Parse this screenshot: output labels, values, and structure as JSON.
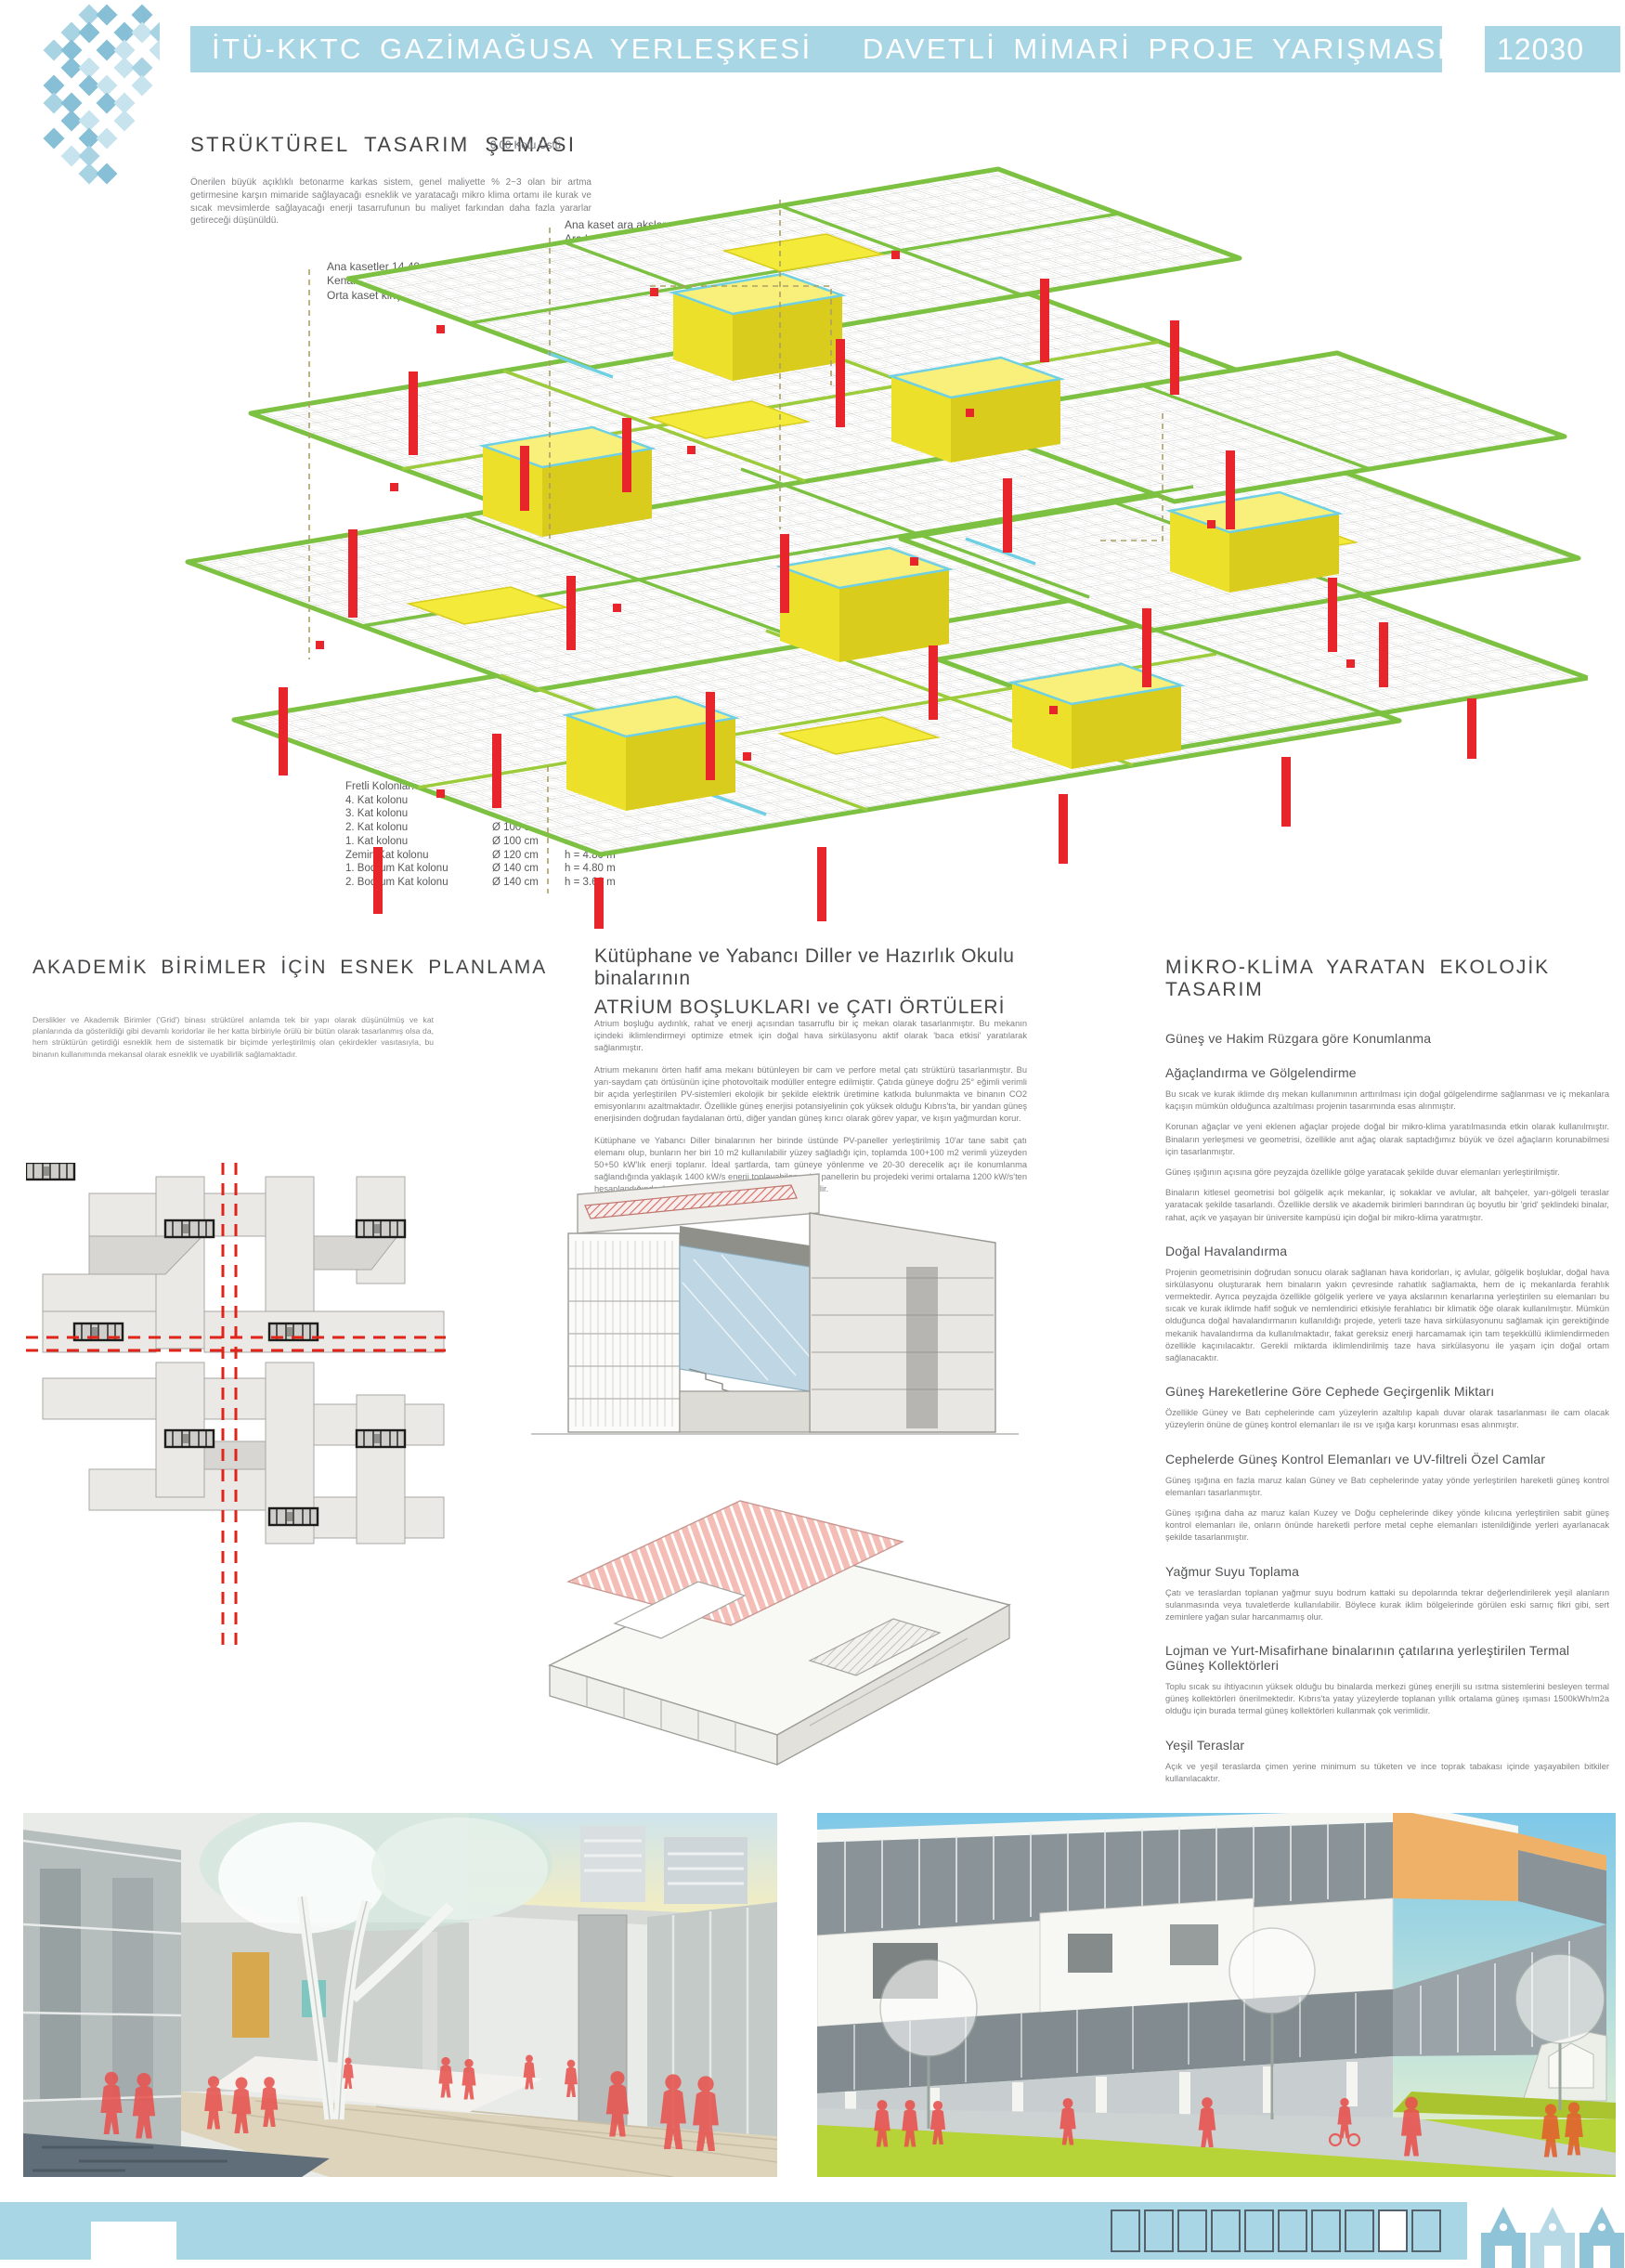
{
  "colors": {
    "header_blue": "#a9d6e5",
    "beam_green": "#7dc142",
    "slab_yellow": "#f3ea39",
    "column_red": "#e8252a",
    "core_cyan": "#6fd0e4",
    "axis_red": "#e0241a",
    "people_red": "#e85450",
    "lawn_green": "#b6d437",
    "accent_orange": "#efb168"
  },
  "header": {
    "title": "İTÜ-KKTC GAZİMAĞUSA YERLEŞKESİ   DAVETLİ MİMARİ PROJE YARIŞMASI",
    "code": "12030",
    "logo": "diamond-weave-logo"
  },
  "structural": {
    "heading": "STRÜKTÜREL  TASARIM  ŞEMASI",
    "subnote": "0.00 Kotu Üstü",
    "intro": "Önerilen büyük açıklıklı betonarme karkas sistem, genel maliyette % 2~3 olan bir artma getirmesine karşın mimaride sağlayacağı esneklik ve yaratacağı mikro klima ortamı ile kurak ve sıcak mevsimlerde sağlayacağı enerji tasarrufunun bu maliyet farkından daha fazla yararlar getireceği düşünüldü.",
    "annotations": {
      "ana_kaset": {
        "line1_label": "Ana kaset ara akslar",
        "line1_value": "4 x 3.60 m",
        "line2_label": "Ara kaset kiriş:",
        "line2_value": "40 / 80 cm"
      },
      "doseme": {
        "label": "Döşeme Plağı:",
        "value1": "3.60 x 3.60 m aks aralığı",
        "value2": "d = 12 cm"
      },
      "kasetler": {
        "line1": "Ana kasetler  14.40 m x 14.40 m  açıklıklı",
        "line2_label": "Kenar kaset kiriş:",
        "line2_value": "60 / 80 cm",
        "line3_label": "Orta kaset kiriş:",
        "line3_value": "80 / 80 cm"
      },
      "cekirdek": {
        "label": "Merdiven-Asansör Çekirdeği:",
        "value1": "14.40 x 4.80 m aks aralığı",
        "value2": "30 cm perde kalınlığı"
      },
      "kolonlar": {
        "title": "Fretli Kolonlar:",
        "rows": [
          {
            "name": "4. Kat kolonu",
            "dia": "Ø 80 cm",
            "h": "h = 3.60 m"
          },
          {
            "name": "3. Kat kolonu",
            "dia": "Ø 80 cm",
            "h": "h = 3.60 m"
          },
          {
            "name": "2. Kat kolonu",
            "dia": "Ø 100 cm",
            "h": "h = 3.60 m"
          },
          {
            "name": "1. Kat kolonu",
            "dia": "Ø 100 cm",
            "h": "h = 3.60 m"
          },
          {
            "name": "Zemin Kat kolonu",
            "dia": "Ø 120 cm",
            "h": "h = 4.80 m"
          },
          {
            "name": "1. Bodrum Kat kolonu",
            "dia": "Ø 140 cm",
            "h": "h = 4.80 m"
          },
          {
            "name": "2. Bodrum Kat kolonu",
            "dia": "Ø 140 cm",
            "h": "h = 3.60 m"
          }
        ]
      }
    }
  },
  "col1": {
    "heading": "AKADEMİK  BİRİMLER  İÇİN  ESNEK  PLANLAMA",
    "body": "Derslikler ve Akademik Birimler ('Grid') binası strüktürel anlamda tek bir yapı olarak düşünülmüş ve kat planlarında da gösterildiği gibi devamlı koridorlar ile her katta birbiriyle örülü bir bütün olarak tasarlanmış olsa da, hem strüktürün getirdiği esneklik hem de sistematik bir biçimde yerleştirilmiş olan çekirdekler vasıtasıyla, bu binanın kullanımında mekansal olarak esneklik ve uyabilirlik sağlamaktadır."
  },
  "col2": {
    "heading_line1": "Kütüphane ve Yabancı Diller ve Hazırlık Okulu binalarının",
    "heading_line2": "ATRİUM BOŞLUKLARI ve ÇATI ÖRTÜLERİ",
    "para1": "Atrium boşluğu aydınlık, rahat ve enerji açısından tasarruflu bir iç mekan olarak tasarlanmıştır. Bu mekanın içindeki iklimlendirmeyi optimize etmek için doğal hava sirkülasyonu aktif olarak 'baca etkisi' yaratılarak sağlanmıştır.",
    "para2": "Atrium mekanını örten hafif ama mekanı bütünleyen bir cam ve perfore metal çatı strüktürü tasarlanmıştır. Bu yarı-saydam çatı örtüsünün içine photovoltaik modüller entegre edilmiştir. Çatıda güneye doğru 25° eğimli verimli bir açıda yerleştirilen PV-sistemleri ekolojik bir şekilde elektrik üretimine katkıda bulunmakta ve binanın CO2 emisyonlarını azaltmaktadır. Özellikle güneş enerjisi potansiyelinin çok yüksek olduğu Kıbrıs'ta, bir yandan güneş enerjisinden doğrudan faydalanan örtü, diğer yandan güneş kırıcı olarak görev yapar, ve kışın yağmurdan korur.",
    "para3": "Kütüphane ve Yabancı Diller binalarının her birinde üstünde PV-paneller yerleştirilmiş 10'ar tane sabit çatı elemanı olup, bunların her biri 10 m2 kullanılabilir yüzey sağladığı için, toplamda 100+100 m2 verimli yüzeyden 50+50 kW'lık enerji toplanır. İdeal şartlarda, tam güneye yönlenme ve 20-30 derecelik açı ile konumlanma sağlandığında yaklaşık 1400 kW/s enerji toplayabilen solar panellerin bu projedeki verimi ortalama 1200 kW/s'ten hesaplandığında, her binada 60.000 kW/s üretim sağlanabilir."
  },
  "col3": {
    "heading": "MİKRO-KLİMA  YARATAN  EKOLOJİK  TASARIM",
    "sections": [
      {
        "h": "Güneş ve Hakim Rüzgara göre Konumlanma",
        "paras": []
      },
      {
        "h": "Ağaçlandırma ve Gölgelendirme",
        "paras": [
          "Bu sıcak ve kurak iklimde dış mekan kullanımının arttırılması için doğal gölgelendirme sağlanması ve iç mekanlara kaçışın mümkün olduğunca azaltılması projenin tasarımında esas alınmıştır.",
          "Korunan ağaçlar ve yeni eklenen ağaçlar projede doğal bir mikro-klima yaratılmasında etkin olarak kullanılmıştır. Binaların yerleşmesi ve geometrisi, özellikle anıt ağaç olarak saptadığımız büyük ve özel ağaçların korunabilmesi için tasarlanmıştır.",
          "Güneş ışığının açısına göre peyzajda özellikle gölge yaratacak şekilde duvar elemanları yerleştirilmiştir.",
          "Binaların kitlesel geometrisi bol gölgelik açık mekanlar, iç sokaklar ve avlular, alt bahçeler, yarı-gölgeli teraslar yaratacak şekilde tasarlandı. Özellikle derslik ve akademik birimleri barındıran üç boyutlu bir 'grid' şeklindeki binalar, rahat, açık ve yaşayan bir üniversite kampüsü için doğal bir mikro-klima yaratmıştır."
        ]
      },
      {
        "h": "Doğal Havalandırma",
        "paras": [
          "Projenin geometrisinin doğrudan sonucu olarak sağlanan hava koridorları, iç avlular, gölgelik boşluklar, doğal hava sirkülasyonu oluşturarak hem binaların yakın çevresinde rahatlık sağlamakta, hem de iç mekanlarda ferahlık vermektedir. Ayrıca peyzajda özellikle gölgelik yerlere ve yaya akslarının kenarlarına yerleştirilen su elemanları bu sıcak ve kurak iklimde hafif soğuk ve nemlendirici etkisiyle ferahlatıcı bir klimatik öğe olarak kullanılmıştır. Mümkün olduğunca doğal havalandırmanın kullanıldığı projede, yeterli taze hava sirkülasyonunu sağlamak için gerektiğinde mekanik havalandırma da kullanılmaktadır, fakat gereksiz enerji harcamamak için tam teşekküllü iklimlendirmeden özellikle kaçınılacaktır. Gerekli miktarda iklimlendirilmiş taze hava sirkülasyonu ile yaşam için doğal ortam sağlanacaktır."
        ]
      },
      {
        "h": "Güneş Hareketlerine Göre Cephede Geçirgenlik Miktarı",
        "paras": [
          "Özellikle Güney ve Batı cephelerinde cam yüzeylerin azaltılıp kapalı duvar olarak tasarlanması ile cam olacak yüzeylerin önüne de güneş kontrol elemanları ile ısı ve ışığa karşı korunması esas alınmıştır."
        ]
      },
      {
        "h": "Cephelerde Güneş Kontrol Elemanları ve UV-filtreli Özel Camlar",
        "paras": [
          "Güneş ışığına en fazla maruz kalan Güney ve Batı cephelerinde yatay yönde yerleştirilen hareketli güneş kontrol elemanları tasarlanmıştır.",
          "Güneş ışığına daha az maruz kalan Kuzey ve Doğu cephelerinde dikey yönde kılıcına yerleştirilen sabit güneş kontrol elemanları ile, onların önünde hareketli perfore metal cephe elemanları istenildiğinde yerleri ayarlanacak şekilde tasarlanmıştır."
        ]
      },
      {
        "h": "Yağmur Suyu Toplama",
        "paras": [
          "Çatı ve teraslardan toplanan yağmur suyu bodrum kattaki su depolarında tekrar değerlendirilerek yeşil alanların sulanmasında veya tuvaletlerde kullanılabilir. Böylece kurak iklim bölgelerinde görülen eski sarnıç fikri gibi, sert zeminlere yağan sular harcanmamış olur."
        ]
      },
      {
        "h": "Lojman ve Yurt-Misafirhane binalarının çatılarına yerleştirilen Termal Güneş Kollektörleri",
        "paras": [
          "Toplu sıcak su ihtiyacının yüksek olduğu bu binalarda merkezi güneş enerjili su ısıtma sistemlerini besleyen termal güneş kollektörleri önerilmektedir. Kıbrıs'ta yatay yüzeylerde toplanan yıllık ortalama güneş ışıması 1500kWh/m2a olduğu için burada termal güneş kollektörleri kullanmak çok verimlidir."
        ]
      },
      {
        "h": "Yeşil Teraslar",
        "paras": [
          "Açık ve yeşil teraslarda çimen yerine minimum su tüketen ve ince toprak tabakası içinde yaşayabilen bitkiler kullanılacaktır."
        ]
      }
    ]
  },
  "footer": {
    "page_boxes": 10,
    "active_box": 9,
    "landmark_icon": "famagusta-gable-silhouettes",
    "door_notch": "white-notch"
  }
}
